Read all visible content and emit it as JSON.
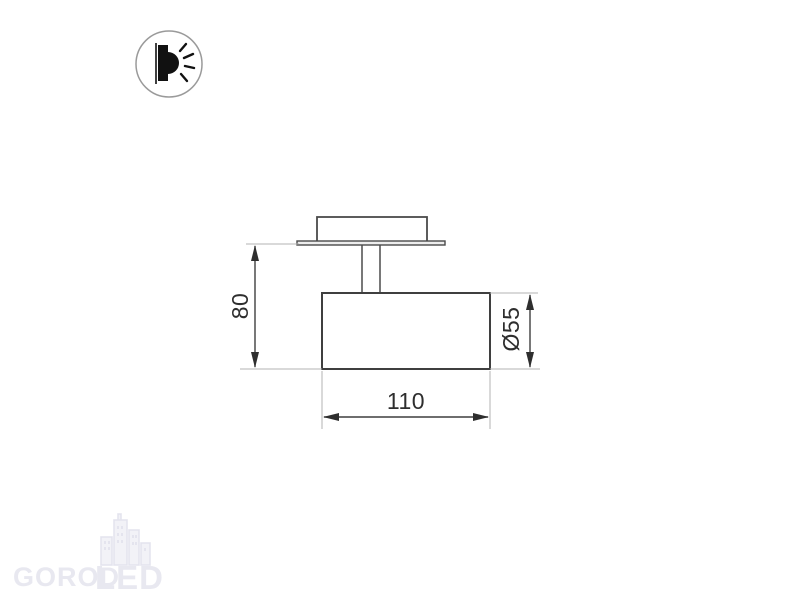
{
  "page": {
    "background": "#ffffff"
  },
  "badge": {
    "icon": "wall-mounted-light-icon"
  },
  "drawing": {
    "dimensions": {
      "height": "80",
      "width": "110",
      "diameter": "Ø55"
    }
  },
  "watermark": {
    "brand_left": "GOROD",
    "brand_right": "LED"
  },
  "colors": {
    "drawing_line": "#3f3f3f",
    "extension_line": "#b3b3b3",
    "dimension_text": "#2e2e2e",
    "watermark": "#e8e8f0",
    "badge_ring": "#9a9a9a",
    "badge_glyph": "#111111"
  }
}
